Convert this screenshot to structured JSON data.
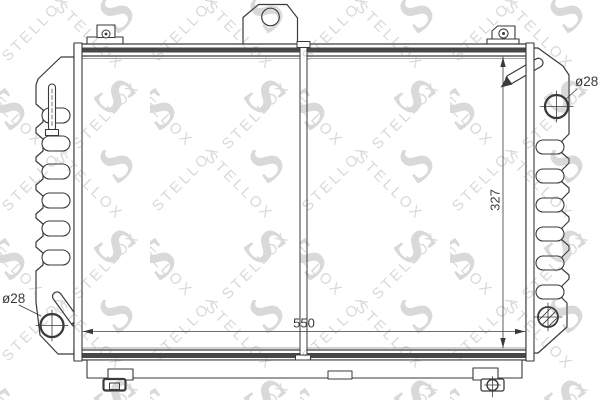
{
  "drawing": {
    "labels": {
      "width": "550",
      "height": "327",
      "inlet_diameter": "ø28",
      "outlet_diameter": "ø28"
    },
    "watermark": {
      "brand": "STELLOX",
      "logo_letter": "S",
      "color": "#d9d9d9"
    },
    "colors": {
      "line": "#3a3a3a",
      "rail_fill": "#474747",
      "background": "#ffffff"
    }
  }
}
